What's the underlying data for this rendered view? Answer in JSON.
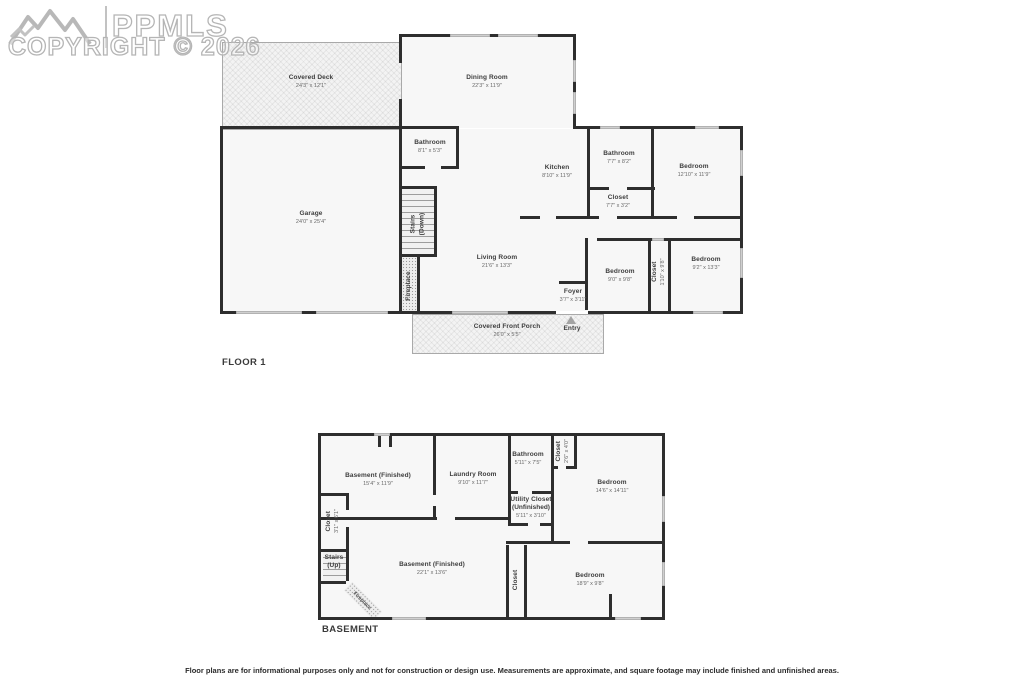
{
  "watermark": {
    "brand": "PPMLS",
    "copyright": "COPYRIGHT © 2026"
  },
  "floor1": {
    "title": "FLOOR 1",
    "rooms": {
      "covered_deck": {
        "name": "Covered Deck",
        "dims": "24'3\" x 12'1\""
      },
      "dining_room": {
        "name": "Dining Room",
        "dims": "22'3\" x 11'9\""
      },
      "bathroom_a": {
        "name": "Bathroom",
        "dims": "8'1\" x 5'3\""
      },
      "kitchen": {
        "name": "Kitchen",
        "dims": "8'10\" x 11'9\""
      },
      "bathroom_b": {
        "name": "Bathroom",
        "dims": "7'7\" x 8'2\""
      },
      "closet_hall": {
        "name": "Closet",
        "dims": "7'7\" x 3'2\""
      },
      "bedroom_ne": {
        "name": "Bedroom",
        "dims": "12'10\" x 11'9\""
      },
      "garage": {
        "name": "Garage",
        "dims": "24'0\" x 25'4\""
      },
      "stairs_down": {
        "name": "Stairs",
        "sub": "(Down)"
      },
      "fireplace": {
        "name": "Fireplace"
      },
      "living_room": {
        "name": "Living Room",
        "dims": "21'6\" x 13'3\""
      },
      "bedroom_mid": {
        "name": "Bedroom",
        "dims": "9'0\" x 9'8\""
      },
      "closet_mid": {
        "name": "Closet",
        "dims": "1'10\" x 9'8\""
      },
      "bedroom_se": {
        "name": "Bedroom",
        "dims": "9'2\" x 13'3\""
      },
      "foyer": {
        "name": "Foyer",
        "dims": "3'7\" x 3'11\""
      },
      "porch": {
        "name": "Covered Front Porch",
        "dims": "26'0\" x 5'5\""
      },
      "entry": {
        "name": "Entry"
      }
    }
  },
  "basement": {
    "title": "BASEMENT",
    "rooms": {
      "bsmt_fin_a": {
        "name": "Basement (Finished)",
        "dims": "15'4\" x 11'9\""
      },
      "laundry": {
        "name": "Laundry Room",
        "dims": "9'10\" x 11'7\""
      },
      "bathroom": {
        "name": "Bathroom",
        "dims": "5'11\" x 7'5\""
      },
      "closet_a": {
        "name": "Closet",
        "dims": "2'6\" x 4'0\""
      },
      "bedroom_a": {
        "name": "Bedroom",
        "dims": "14'6\" x 14'11\""
      },
      "utility": {
        "name": "Utility Closet",
        "sub": "(Unfinished)",
        "dims": "5'11\" x 3'10\""
      },
      "closet_b": {
        "name": "Closet",
        "dims": "3'1\" x 6'1\""
      },
      "stairs_up": {
        "name": "Stairs",
        "sub": "(Up)"
      },
      "bsmt_fin_b": {
        "name": "Basement (Finished)",
        "dims": "22'1\" x 13'6\""
      },
      "closet_c": {
        "name": "Closet"
      },
      "bedroom_b": {
        "name": "Bedroom",
        "dims": "18'9\" x 9'8\""
      },
      "fireplace": {
        "name": "Fireplace"
      }
    }
  },
  "disclaimer": "Floor plans are for informational purposes only and not for construction or design use. Measurements are approximate, and square footage may include finished and unfinished areas.",
  "colors": {
    "wall": "#2e2e2e",
    "room_fill": "#f7f7f7",
    "window": "#cfcfcf",
    "watermark": "#b5b5b5"
  }
}
